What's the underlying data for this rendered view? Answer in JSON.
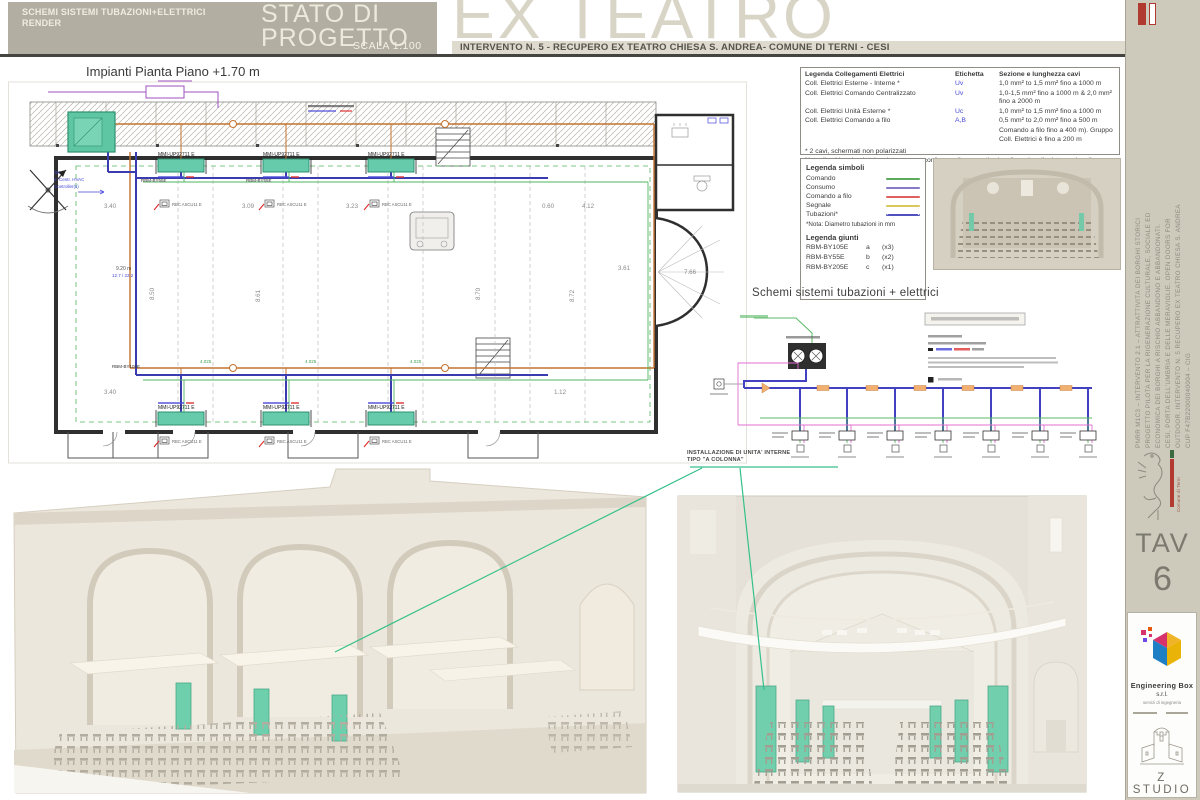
{
  "colors": {
    "teal_unit": "#66cbaa",
    "pipe_orange": "#c4732f",
    "pipe_blue": "#3b3bb0",
    "leader_green": "#35c08a",
    "header_olive": "#b2aea1",
    "title_beige": "#d9d5c6"
  },
  "header": {
    "discipline_line1": "SCHEMI SISTEMI TUBAZIONI+ELETTRICI",
    "discipline_line2": "RENDER",
    "status_line1": "STATO DI",
    "status_line2": "PROGETTO",
    "scale": "SCALA 1:100",
    "title": "EX TEATRO",
    "subtitle": "INTERVENTO N. 5 - RECUPERO EX TEATRO CHIESA S. ANDREA- COMUNE DI TERNI - CESI"
  },
  "plan": {
    "title": "Impianti Pianta Piano +1.70 m",
    "indoor_unit_label": "MMI-UP92711 E",
    "joint_label_a": "RBM-BY55E",
    "joint_label_b": "RBM-BY105E",
    "controller_label": "RBC ASCU11 E",
    "pipe_length_label": "4.025",
    "riser_note_line1": "9.20 m",
    "riser_note_line2": "12.7 / 22.2",
    "ctrl_note_line1": "OK",
    "ctrl_note_line2": "to Centr. HVAC",
    "ctrl_note_line3": "Controller(s)",
    "dims": {
      "d1": "3.40",
      "d2": "3.09",
      "d3": "3.23",
      "d4": "0.60",
      "d5": "4.12",
      "v1": "8.50",
      "v2": "8.61",
      "v3": "8.70",
      "v4": "8.72",
      "r1": "3.61",
      "r2": "7.66",
      "b1": "3.40",
      "b2": "1.12"
    }
  },
  "legend_cavi": {
    "col1": "Legenda Collegamenti Elettrici",
    "col2": "Etichetta",
    "col3": "Sezione e lunghezza cavi",
    "rows": [
      {
        "label": "Coll. Elettrici Esterne - Interne *",
        "tag": "Uv",
        "spec": "1,0 mm² to 1,5 mm² fino a 1000 m"
      },
      {
        "label": "Coll. Elettrici Comando Centralizzato",
        "tag": "Uv",
        "spec": "1,0-1,5 mm² fino a 1000 m & 2,0 mm² fino a 2000 m"
      },
      {
        "label": "Coll. Elettrici Unità Esterne *",
        "tag": "Uc",
        "spec": "1,0 mm² to 1,5 mm² fino a 1000 m"
      },
      {
        "label": "Coll. Elettrici Comando a filo",
        "tag": "A,B",
        "spec": "0,5 mm² to 2,0 mm² fino a  500 m"
      }
    ],
    "extra1": "Comando a filo fino a  400 m). Gruppo",
    "extra2": "Coll. Elettrici è fino a 200 m",
    "footnote1": "* 2 cavi, schermati non polarizzati",
    "footnote2": "Nota: il cablaggio elettrico deve essere conforme alle normative locali, nazionali e internazionali."
  },
  "legend_simboli": {
    "title": "Legenda simboli",
    "items": [
      {
        "label": "Comando",
        "color": "#5cab5c"
      },
      {
        "label": "Consumo",
        "color": "#8878c8"
      },
      {
        "label": "Comando a filo",
        "color": "#e06060"
      },
      {
        "label": "Segnale",
        "color": "#d9c85b"
      },
      {
        "label": "Tubazioni*",
        "color": "#5050c0"
      }
    ],
    "note": "*Nota: Diametro tubazioni in mm"
  },
  "legend_giunti": {
    "title": "Legenda giunti",
    "rows": [
      {
        "model": "RBM-BY105E",
        "key": "a",
        "qty": "(x3)"
      },
      {
        "model": "RBM-BY55E",
        "key": "b",
        "qty": "(x2)"
      },
      {
        "model": "RBM-BY205E",
        "key": "c",
        "qty": "(x1)"
      }
    ]
  },
  "schematic": {
    "title": "Schemi sistemi tubazioni + elettrici"
  },
  "annotation": {
    "line1": "INSTALLAZIONE DI UNITA' INTERNE",
    "line2": "TIPO \"A COLONNA\""
  },
  "sidebar": {
    "project_lines": [
      "PNRR M1C3 – INTERVENTO 2.1 – ATTRATTIVITÀ DEI BORGHI STORICI",
      "PROGETTO PILOTA PER LA RIGENERAZIONE CULTURALE, SOCIALE ED",
      "ECONOMICA DEI BORGHI A RISCHIO ABBANDONO E ABBANDONATI.",
      "CESI, PORTA DELL'UMBRIA E DELLE MERAVIGLIE. OPEN DOORS FOR",
      "OUTDOOR. INTERVENTO N. 5 RECUPERO EX TEATRO CHIESA S. ANDREA",
      "CUP F47B22000040004 – CIG"
    ],
    "comune": "Comune di Terni",
    "tav_label": "TAV",
    "tav_number": "6",
    "firm_name": "Engineering Box",
    "firm_suffix": "s.r.l.",
    "firm_tagline": "servizi di ingegneria",
    "studio": "Z STUDIO"
  }
}
